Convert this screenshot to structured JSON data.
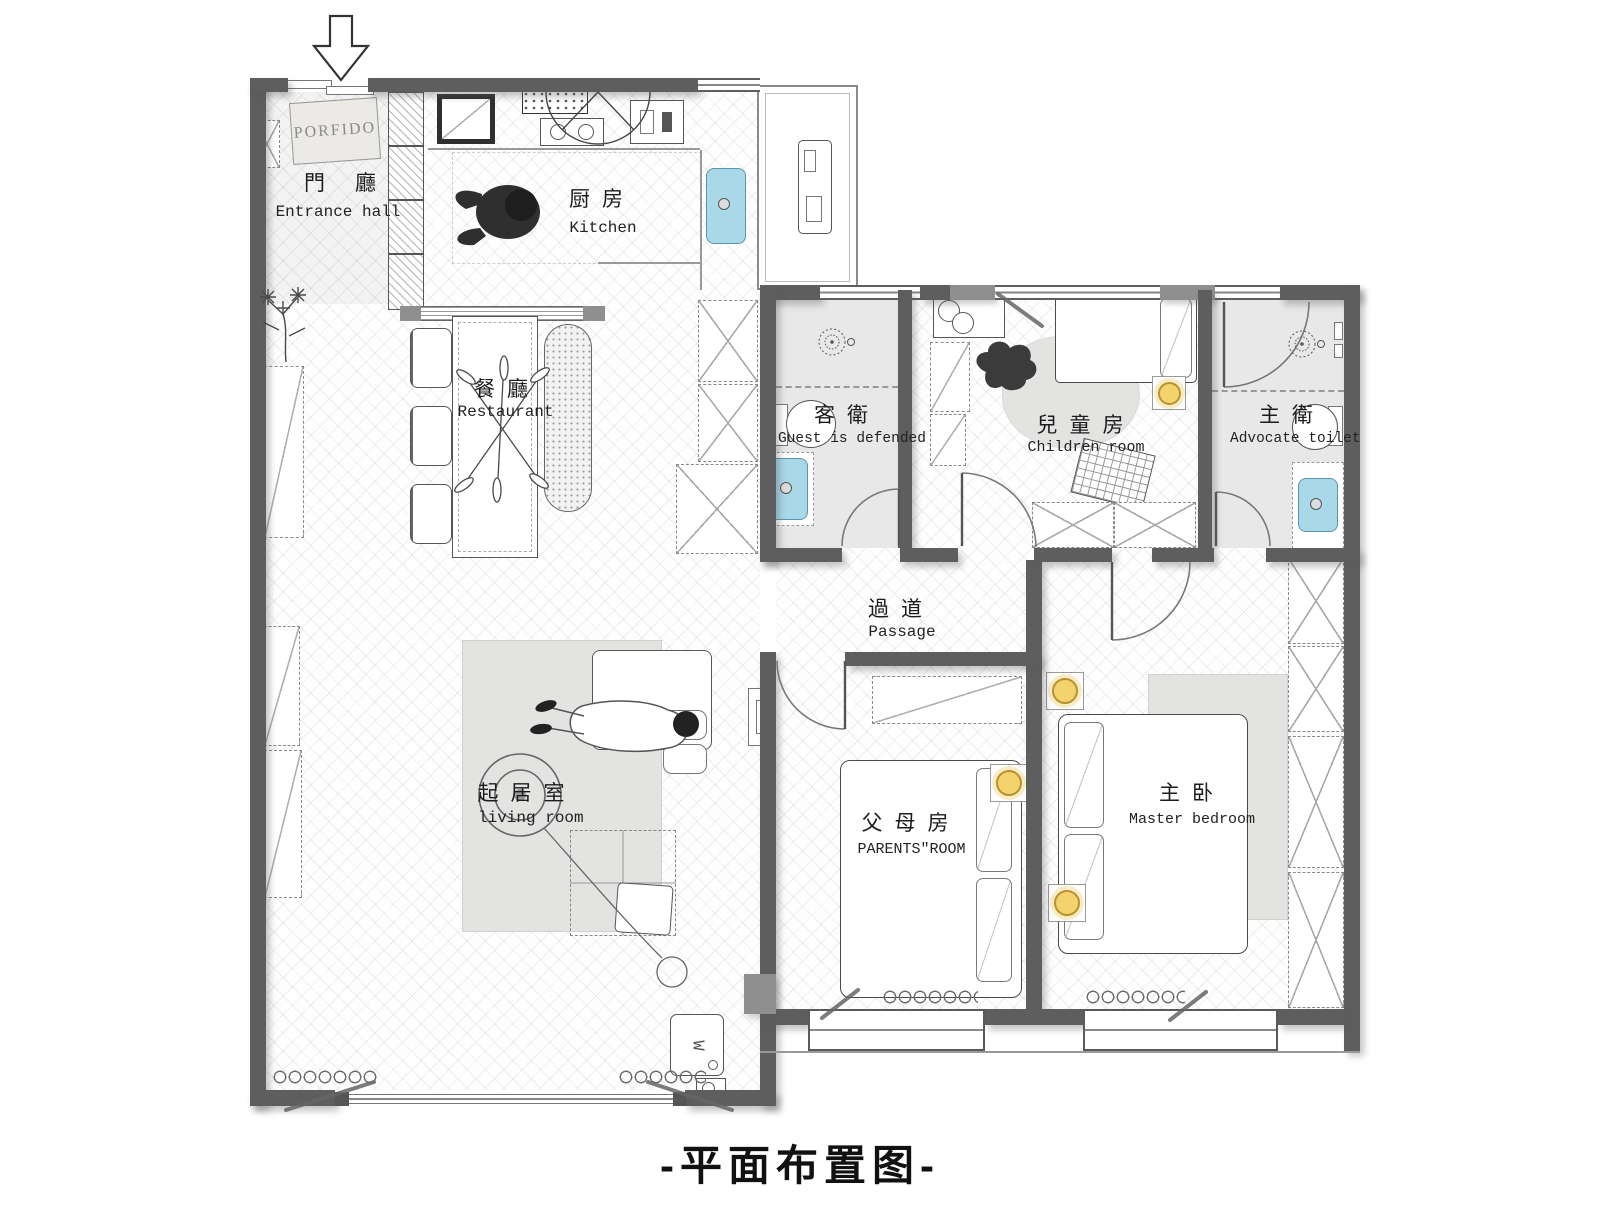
{
  "title": "-平面布置图-",
  "rooms": {
    "entrance": {
      "cn": "門廳",
      "en": "Entrance hall"
    },
    "kitchen": {
      "cn": "厨房",
      "en": "Kitchen"
    },
    "restaurant": {
      "cn": "餐廳",
      "en": "Restaurant"
    },
    "guest_bath": {
      "cn": "客衛",
      "en": "Guest is defended"
    },
    "children_room": {
      "cn": "兒童房",
      "en": "Children room"
    },
    "master_bath": {
      "cn": "主衛",
      "en": "Advocate toilet"
    },
    "passage": {
      "cn": "過道",
      "en": "Passage"
    },
    "living_room": {
      "cn": "起居室",
      "en": "living room"
    },
    "parents_room": {
      "cn": "父母房",
      "en": "PARENTS\"ROOM"
    },
    "master_bedroom": {
      "cn": "主卧",
      "en": "Master bedroom"
    }
  },
  "labels": {
    "doormat": "PORFIDO",
    "washer": "W"
  },
  "colors": {
    "wall": "#5e5e5e",
    "wall_light": "#8f8f8f",
    "sink_blue": "#a9d9e8",
    "downlight_yellow": "#f2d36e",
    "bath_floor": "#e8e8e8"
  }
}
